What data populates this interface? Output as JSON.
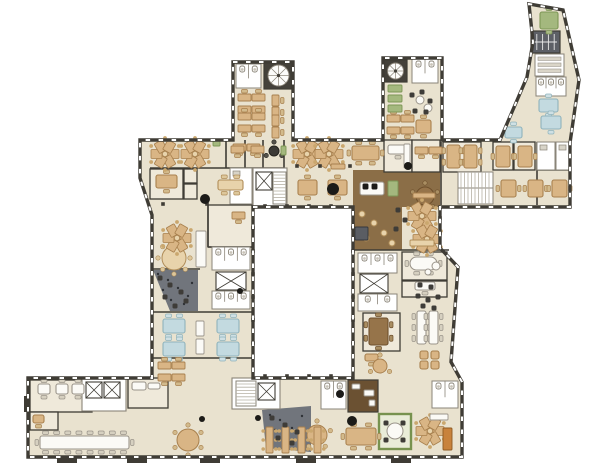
{
  "meta": {
    "app": "office-building-floor-plan"
  },
  "palette": {
    "bg": "#ffffff",
    "floor": "#e9e2cf",
    "floorLight": "#efe9da",
    "wall": "#3f3c35",
    "wallLight": "#8a8478",
    "wood": "#8b6e47",
    "woodDark": "#6b5132",
    "gray": "#71757c",
    "grayDark": "#2f3237",
    "greenDark": "#77924f",
    "black": "#1c1b18",
    "tan": "#d9b585",
    "tanStroke": "#a8804e",
    "blue": "#c3dae0",
    "blueStroke": "#8fb3bc",
    "green": "#a4b87e",
    "white": "#fbfaf6",
    "brown": "#96744a",
    "orange": "#c8823c",
    "chairTan": "#caa76e"
  },
  "footprint": {
    "outer": "M233,62 H293 V140 H383 V58 H442 V140 H500 L527,77 L533,42 L529,4 L563,10 L579,80 L570,143 V207 H440 V248 L458,267 L451,362 L462,382 V457 H28 V378 H152 V215 L140,178 V140 H233 Z",
    "hole": "M253,207 H353 V378 H253 Z"
  },
  "zones": {
    "wood": [
      [
        353,
        170,
        87,
        37
      ],
      [
        353,
        207,
        49,
        43
      ]
    ],
    "woodDark": [
      [
        348,
        380,
        30,
        32
      ]
    ],
    "gray": [
      {
        "path": "M153,270 L198,270 L198,311 L170,311 Z",
        "specks": [
          [
            158,
            274
          ],
          [
            168,
            280
          ],
          [
            178,
            288
          ],
          [
            188,
            296
          ],
          [
            163,
            290
          ],
          [
            184,
            304
          ],
          [
            192,
            283
          ],
          [
            171,
            300
          ]
        ]
      },
      {
        "path": "M262,410 L311,406 L311,452 L266,448 Z",
        "specks": [
          [
            270,
            415
          ],
          [
            280,
            420
          ],
          [
            292,
            428
          ],
          [
            300,
            436
          ],
          [
            275,
            430
          ],
          [
            288,
            442
          ],
          [
            302,
            416
          ],
          [
            268,
            440
          ]
        ]
      }
    ],
    "green": [
      [
        379,
        414,
        32,
        35
      ]
    ]
  },
  "rooms": [
    [
      150,
      169,
      33,
      30
    ],
    [
      184,
      169,
      13,
      14
    ],
    [
      184,
      184,
      13,
      15
    ],
    [
      384,
      140,
      28,
      32
    ],
    [
      412,
      140,
      28,
      32
    ],
    [
      443,
      142,
      38,
      30
    ],
    [
      493,
      142,
      20,
      28
    ],
    [
      514,
      142,
      21,
      28
    ],
    [
      208,
      205,
      45,
      42
    ],
    [
      402,
      252,
      45,
      28
    ],
    [
      402,
      281,
      45,
      16
    ],
    [
      363,
      313,
      37,
      38
    ],
    [
      30,
      380,
      62,
      32
    ],
    [
      30,
      412,
      28,
      18
    ],
    [
      128,
      378,
      40,
      30
    ]
  ],
  "walls": [
    [
      150,
      168,
      284,
      168
    ],
    [
      226,
      140,
      226,
      168
    ],
    [
      245,
      140,
      245,
      168
    ],
    [
      263,
      140,
      263,
      168
    ],
    [
      284,
      140,
      284,
      168
    ],
    [
      441,
      142,
      441,
      205
    ],
    [
      537,
      142,
      537,
      205
    ],
    [
      537,
      170,
      570,
      170
    ],
    [
      208,
      205,
      208,
      247
    ],
    [
      208,
      247,
      253,
      247
    ],
    [
      152,
      269,
      200,
      269
    ],
    [
      152,
      312,
      253,
      312
    ],
    [
      152,
      358,
      253,
      358
    ],
    [
      353,
      250,
      449,
      250
    ]
  ],
  "service": [
    [
      "wc",
      236,
      64,
      25,
      24,
      2
    ],
    [
      "spiral",
      264,
      62,
      29,
      27
    ],
    [
      "wc",
      412,
      59,
      26,
      24,
      2
    ],
    [
      "spiral",
      384,
      60,
      23,
      22
    ],
    [
      "shelfdark",
      531,
      31,
      29,
      22
    ],
    [
      "shelfwhite",
      535,
      54,
      29,
      22
    ],
    [
      "wc",
      536,
      77,
      30,
      19,
      3
    ],
    [
      "roomw",
      537,
      142,
      18,
      28
    ],
    [
      "roomw",
      556,
      142,
      14,
      28
    ],
    [
      "stairh",
      458,
      172,
      35,
      32
    ],
    [
      "corew",
      253,
      168,
      34,
      38
    ],
    [
      "elev",
      256,
      172,
      16,
      18
    ],
    [
      "stairv",
      273,
      172,
      13,
      32
    ],
    [
      "roomw",
      230,
      168,
      22,
      36
    ],
    [
      "wc",
      212,
      247,
      38,
      23,
      3
    ],
    [
      "elev",
      216,
      272,
      30,
      18
    ],
    [
      "wc",
      212,
      291,
      38,
      18,
      3
    ],
    [
      "wc",
      358,
      253,
      39,
      20,
      3
    ],
    [
      "elev",
      360,
      274,
      28,
      19
    ],
    [
      "wc",
      358,
      294,
      39,
      17,
      2
    ],
    [
      "corew",
      82,
      378,
      44,
      33
    ],
    [
      "elev",
      86,
      382,
      16,
      16
    ],
    [
      "elev",
      104,
      382,
      16,
      16
    ],
    [
      "corew",
      232,
      378,
      48,
      31
    ],
    [
      "stairv",
      236,
      381,
      20,
      25
    ],
    [
      "elev",
      258,
      383,
      17,
      17
    ],
    [
      "wc",
      321,
      381,
      25,
      28,
      2
    ],
    [
      "wc",
      432,
      381,
      26,
      27,
      2
    ]
  ],
  "furniture": {
    "tables": [
      [
        352,
        146,
        27,
        14,
        "tan"
      ],
      [
        156,
        175,
        21,
        13,
        "tan"
      ],
      [
        447,
        145,
        13,
        23,
        "tan"
      ],
      [
        464,
        145,
        13,
        23,
        "tan"
      ],
      [
        496,
        146,
        14,
        21,
        "tan"
      ],
      [
        518,
        146,
        14,
        21,
        "tan"
      ],
      [
        298,
        180,
        19,
        15,
        "tan"
      ],
      [
        328,
        180,
        19,
        15,
        "tan"
      ],
      [
        501,
        180,
        15,
        17,
        "tan"
      ],
      [
        528,
        180,
        15,
        17,
        "tan"
      ],
      [
        552,
        180,
        15,
        17,
        "tan"
      ],
      [
        539,
        99,
        19,
        13,
        "blue"
      ],
      [
        541,
        116,
        20,
        13,
        "blue"
      ],
      [
        505,
        127,
        17,
        11,
        "blue"
      ],
      [
        540,
        12,
        18,
        17,
        "green"
      ],
      [
        416,
        120,
        15,
        13,
        "tan"
      ],
      [
        163,
        319,
        22,
        14,
        "blue"
      ],
      [
        163,
        342,
        22,
        14,
        "blue"
      ],
      [
        217,
        319,
        22,
        14,
        "blue"
      ],
      [
        217,
        342,
        22,
        14,
        "blue"
      ],
      [
        369,
        318,
        19,
        27,
        "brown"
      ],
      [
        417,
        311,
        9,
        33,
        "white"
      ],
      [
        429,
        311,
        9,
        33,
        "white"
      ],
      [
        410,
        257,
        27,
        13,
        "white",
        "oval"
      ],
      [
        40,
        436,
        89,
        13,
        "white"
      ],
      [
        38,
        384,
        12,
        10,
        "white"
      ],
      [
        56,
        384,
        12,
        10,
        "white"
      ],
      [
        72,
        384,
        12,
        10,
        "white"
      ],
      [
        346,
        428,
        30,
        17,
        "tan"
      ],
      [
        360,
        182,
        24,
        13,
        "white",
        0
      ],
      [
        218,
        180,
        25,
        10,
        "tanLight"
      ],
      [
        420,
        351,
        8,
        8,
        "tan",
        0
      ],
      [
        431,
        351,
        8,
        8,
        "tan",
        0
      ],
      [
        420,
        361,
        8,
        8,
        "tan",
        0
      ],
      [
        431,
        361,
        8,
        8,
        "tan",
        0
      ],
      [
        33,
        415,
        11,
        8,
        "tan",
        1
      ],
      [
        365,
        354,
        13,
        7,
        "tan",
        1
      ],
      [
        415,
        282,
        20,
        8,
        "white",
        1
      ],
      [
        132,
        382,
        14,
        8,
        "white",
        0
      ],
      [
        388,
        145,
        20,
        9,
        "white",
        1
      ],
      [
        148,
        383,
        12,
        6,
        "white",
        0
      ]
    ],
    "rounds": [
      [
        188,
        440,
        11,
        "tan",
        6
      ],
      [
        317,
        435,
        10,
        "tan",
        5
      ],
      [
        425,
        196,
        9,
        "brown",
        5
      ],
      [
        395,
        431,
        8,
        "white",
        0
      ],
      [
        174,
        258,
        12,
        "tanLight",
        8
      ],
      [
        380,
        366,
        7,
        "tan",
        3
      ],
      [
        274,
        151,
        5,
        "dark",
        3
      ],
      [
        420,
        100,
        4,
        "white",
        0
      ],
      [
        428,
        108,
        4,
        "white",
        0
      ],
      [
        362,
        214,
        3,
        "tanLight",
        0
      ],
      [
        374,
        223,
        3,
        "tanLight",
        0
      ],
      [
        366,
        238,
        3,
        "tanLight",
        0
      ],
      [
        384,
        233,
        3,
        "tanLight",
        0
      ],
      [
        392,
        243,
        3,
        "tanLight",
        0
      ],
      [
        436,
        266,
        4,
        "white",
        0
      ],
      [
        428,
        272,
        3,
        "white",
        0
      ]
    ],
    "desks": [
      [
        238,
        94,
        2,
        2
      ],
      [
        238,
        113,
        2,
        2
      ],
      [
        272,
        95,
        1,
        2,
        "v"
      ],
      [
        272,
        115,
        1,
        2,
        "v"
      ],
      [
        387,
        115,
        2,
        2
      ],
      [
        233,
        144,
        2,
        1
      ],
      [
        415,
        147,
        2,
        1
      ],
      [
        231,
        146,
        1,
        1
      ],
      [
        251,
        146,
        1,
        1
      ],
      [
        232,
        212,
        1,
        1
      ],
      [
        158,
        362,
        2,
        2
      ]
    ],
    "pins": [
      [
        165,
        154
      ],
      [
        195,
        154
      ],
      [
        307,
        154
      ],
      [
        329,
        154
      ],
      [
        177,
        238
      ],
      [
        422,
        216
      ],
      [
        427,
        239
      ],
      [
        430,
        431
      ]
    ],
    "rows": [
      [
        266,
        427
      ],
      [
        282,
        427
      ],
      [
        298,
        427
      ],
      [
        314,
        427
      ]
    ],
    "benches": [
      [
        331,
        164,
        14,
        5,
        "tan"
      ],
      [
        413,
        193,
        22,
        5,
        "tan"
      ],
      [
        410,
        240,
        24,
        6,
        "tanLight"
      ],
      [
        196,
        231,
        10,
        36,
        "white"
      ],
      [
        196,
        321,
        8,
        15,
        "white"
      ],
      [
        196,
        339,
        8,
        15,
        "white"
      ],
      [
        355,
        227,
        13,
        13,
        "grayB"
      ],
      [
        388,
        181,
        10,
        15,
        "green"
      ],
      [
        404,
        144,
        6,
        24,
        "white"
      ],
      [
        363,
        184,
        5,
        5,
        "black"
      ],
      [
        372,
        184,
        5,
        5,
        "black"
      ],
      [
        443,
        428,
        9,
        22,
        "orange"
      ],
      [
        430,
        414,
        18,
        6,
        "white"
      ],
      [
        388,
        85,
        14,
        7,
        "green"
      ],
      [
        388,
        95,
        14,
        7,
        "green"
      ],
      [
        388,
        105,
        14,
        7,
        "green"
      ],
      [
        281,
        146,
        5,
        9,
        "green"
      ],
      [
        213,
        141,
        7,
        5,
        "green"
      ],
      [
        352,
        384,
        8,
        5,
        "white"
      ],
      [
        364,
        390,
        10,
        6,
        "white"
      ],
      [
        369,
        400,
        6,
        6,
        "white"
      ]
    ],
    "chairs": [
      [
        160,
        278
      ],
      [
        170,
        285
      ],
      [
        181,
        292
      ],
      [
        165,
        297
      ],
      [
        186,
        301
      ],
      [
        175,
        306
      ],
      [
        272,
        418
      ],
      [
        285,
        425
      ],
      [
        297,
        432
      ],
      [
        278,
        438
      ],
      [
        292,
        443
      ],
      [
        412,
        95
      ],
      [
        422,
        92
      ],
      [
        430,
        101
      ],
      [
        415,
        111
      ],
      [
        426,
        112
      ],
      [
        418,
        296
      ],
      [
        428,
        300
      ],
      [
        438,
        297
      ],
      [
        423,
        306
      ],
      [
        434,
        308
      ],
      [
        386,
        423
      ],
      [
        403,
        423
      ],
      [
        386,
        440
      ],
      [
        403,
        440
      ],
      [
        398,
        210
      ],
      [
        405,
        220
      ],
      [
        396,
        229
      ],
      [
        420,
        285
      ],
      [
        431,
        287
      ]
    ]
  },
  "dots": [
    [
      205,
      199,
      5
    ],
    [
      333,
      189,
      6
    ],
    [
      408,
      166,
      4
    ],
    [
      340,
      394,
      4
    ],
    [
      352,
      421,
      5
    ],
    [
      202,
      419,
      3
    ],
    [
      258,
      418,
      3
    ],
    [
      240,
      291,
      3
    ]
  ],
  "cols": [
    [
      265,
      206
    ],
    [
      287,
      206
    ],
    [
      309,
      206
    ],
    [
      331,
      206
    ],
    [
      265,
      376
    ],
    [
      287,
      376
    ],
    [
      309,
      376
    ],
    [
      331,
      376
    ],
    [
      253,
      228
    ],
    [
      253,
      251
    ],
    [
      253,
      274
    ],
    [
      253,
      297
    ],
    [
      253,
      320
    ],
    [
      253,
      343
    ],
    [
      353,
      228
    ],
    [
      353,
      251
    ],
    [
      353,
      274
    ],
    [
      353,
      297
    ],
    [
      353,
      320
    ],
    [
      353,
      343
    ],
    [
      297,
      166
    ],
    [
      320,
      166
    ],
    [
      350,
      166
    ],
    [
      163,
      204
    ],
    [
      207,
      204
    ],
    [
      440,
      218
    ],
    [
      440,
      233
    ]
  ],
  "porches": [
    [
      57,
      456,
      20,
      7
    ],
    [
      127,
      456,
      20,
      7
    ],
    [
      200,
      456,
      20,
      7
    ],
    [
      296,
      456,
      20,
      7
    ],
    [
      391,
      456,
      20,
      7
    ],
    [
      24,
      396,
      5,
      16
    ]
  ]
}
